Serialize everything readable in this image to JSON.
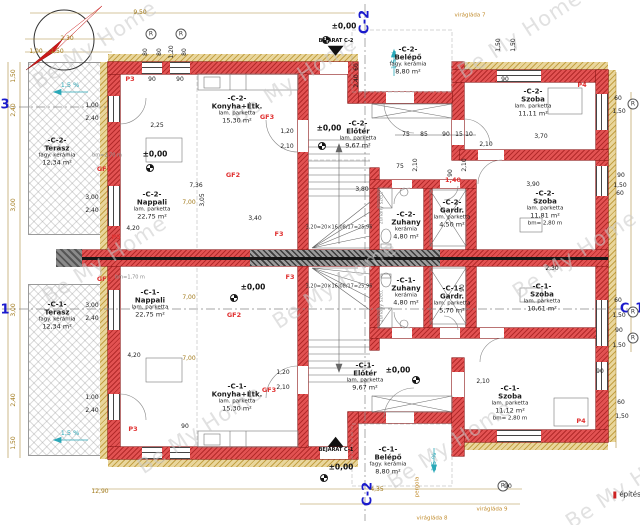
{
  "colors": {
    "wall": "#e25252",
    "insulation": "#e9d69c",
    "section_blue": "#1a1acc",
    "label_red": "#e03131",
    "slope_cyan": "#2aa8b8",
    "dim_orange": "#a07818",
    "watermark": "#c9c9c9"
  },
  "watermark_text": "Be My Home",
  "rooms": [
    {
      "u": "-C-2-",
      "n": "Terasz",
      "f": "fagy. kerámia",
      "a": "12,34 m²",
      "x": 57,
      "y": 152
    },
    {
      "u": "-C-1-",
      "n": "Terasz",
      "f": "fagy. kerámia",
      "a": "12,34 m²",
      "x": 57,
      "y": 316
    },
    {
      "u": "-C-2-",
      "n": "Nappali",
      "f": "lam. parketta",
      "a": "22,75 m²",
      "x": 152,
      "y": 206
    },
    {
      "u": "-C-1-",
      "n": "Nappali",
      "f": "lam. parketta",
      "a": "22,75 m²",
      "x": 150,
      "y": 304
    },
    {
      "u": "-C-2-",
      "n": "Konyha+Étk.",
      "f": "lam. parketta",
      "a": "15,30 m²",
      "x": 237,
      "y": 110
    },
    {
      "u": "-C-1-",
      "n": "Konyha+Étk.",
      "f": "lam. parketta",
      "a": "15,30 m²",
      "x": 237,
      "y": 398
    },
    {
      "u": "-C-2-",
      "n": "Előtér",
      "f": "lam. parketta",
      "a": "9,67 m²",
      "x": 358,
      "y": 135
    },
    {
      "u": "-C-1-",
      "n": "Előtér",
      "f": "lam. parketta",
      "a": "9,67 m²",
      "x": 365,
      "y": 377
    },
    {
      "u": "-C-2-",
      "n": "Zuhany",
      "f": "kerámia",
      "a": "4,80 m²",
      "x": 406,
      "y": 226
    },
    {
      "u": "-C-1-",
      "n": "Zuhany",
      "f": "kerámia",
      "a": "4,80 m²",
      "x": 406,
      "y": 292
    },
    {
      "u": "-C-2-",
      "n": "Gardr.",
      "f": "lam. parketta",
      "a": "4,50 m²",
      "x": 452,
      "y": 214
    },
    {
      "u": "-C-1-",
      "n": "Gardr.",
      "f": "lam. parketta",
      "a": "5,70 m²",
      "x": 452,
      "y": 300
    },
    {
      "u": "-C-2-",
      "n": "Szoba",
      "f": "lam. parketta",
      "a": "11,11 m²",
      "x": 533,
      "y": 103
    },
    {
      "u": "-C-2-",
      "n": "Szoba",
      "f": "lam. parketta",
      "a": "11,81 m²",
      "b": "bm= 2,80 m",
      "x": 545,
      "y": 208
    },
    {
      "u": "-C-1-",
      "n": "Szoba",
      "f": "lam. parketta",
      "a": "10,61 m²",
      "x": 542,
      "y": 298
    },
    {
      "u": "-C-1-",
      "n": "Szoba",
      "f": "lam. parketta",
      "a": "11,12 m²",
      "b": "bm= 2,80 m",
      "x": 510,
      "y": 403
    },
    {
      "u": "-C-2-",
      "n": "Belépő",
      "f": "fagy. kerámia",
      "a": "8,80 m²",
      "x": 408,
      "y": 61
    },
    {
      "u": "-C-1-",
      "n": "Belépő",
      "f": "fagy. kerámia",
      "a": "8,80 m²",
      "x": 388,
      "y": 461
    }
  ],
  "entrances": [
    {
      "label": "BEJÁRAT C-2",
      "x": 336,
      "y": 47,
      "dir": "down"
    },
    {
      "label": "BEJÁRAT C-1",
      "x": 336,
      "y": 445,
      "dir": "up"
    }
  ],
  "annotations": [
    {
      "t": "Be My Home",
      "x": 95,
      "y": 45,
      "c": "wm",
      "r": -33,
      "n": "watermark"
    },
    {
      "t": "Be My Home",
      "x": 295,
      "y": 80,
      "c": "wm",
      "r": -33,
      "n": "watermark"
    },
    {
      "t": "Be My Home",
      "x": 520,
      "y": 35,
      "c": "wm",
      "r": -33,
      "n": "watermark"
    },
    {
      "t": "Be My Home",
      "x": 105,
      "y": 260,
      "c": "wm",
      "r": -33,
      "n": "watermark"
    },
    {
      "t": "Be My Home",
      "x": 335,
      "y": 285,
      "c": "wm",
      "r": -33,
      "n": "watermark"
    },
    {
      "t": "Be My Home",
      "x": 575,
      "y": 255,
      "c": "wm",
      "r": -33,
      "n": "watermark"
    },
    {
      "t": "Be My Home",
      "x": 200,
      "y": 430,
      "c": "wm",
      "r": -33,
      "n": "watermark"
    },
    {
      "t": "Be My Home",
      "x": 450,
      "y": 445,
      "c": "wm",
      "r": -33,
      "n": "watermark"
    },
    {
      "t": "Be My Home",
      "x": 628,
      "y": 485,
      "c": "wm",
      "r": -33,
      "n": "watermark"
    },
    {
      "t": "C-2",
      "x": 365,
      "y": 22,
      "c": "sec",
      "r": -90,
      "n": "section-label"
    },
    {
      "t": "C-2",
      "x": 368,
      "y": 494,
      "c": "sec",
      "r": -90,
      "n": "section-label"
    },
    {
      "t": "3",
      "x": 5,
      "y": 105,
      "c": "sec",
      "n": "section-label"
    },
    {
      "t": "1",
      "x": 5,
      "y": 310,
      "c": "sec",
      "n": "section-label"
    },
    {
      "t": "C-1",
      "x": 632,
      "y": 309,
      "c": "sec",
      "n": "section-label"
    },
    {
      "t": "±0,00",
      "x": 344,
      "y": 26,
      "c": "kb",
      "n": "level-text"
    },
    {
      "t": "±0,00",
      "x": 155,
      "y": 154,
      "c": "kb",
      "n": "level-text"
    },
    {
      "t": "±0,00",
      "x": 329,
      "y": 128,
      "c": "kb",
      "n": "level-text"
    },
    {
      "t": "±0,00",
      "x": 253,
      "y": 287,
      "c": "kb",
      "n": "level-text"
    },
    {
      "t": "±0,00",
      "x": 398,
      "y": 370,
      "c": "kb",
      "n": "level-text"
    },
    {
      "t": "±0,00",
      "x": 341,
      "y": 467,
      "c": "kb",
      "n": "level-text"
    },
    {
      "t": "",
      "x": 326,
      "y": 40,
      "c": "lvl",
      "n": "level-marker-icon"
    },
    {
      "t": "",
      "x": 150,
      "y": 168,
      "c": "lvl",
      "n": "level-marker-icon"
    },
    {
      "t": "",
      "x": 322,
      "y": 146,
      "c": "lvl",
      "n": "level-marker-icon"
    },
    {
      "t": "",
      "x": 234,
      "y": 298,
      "c": "lvl",
      "n": "level-marker-icon"
    },
    {
      "t": "",
      "x": 416,
      "y": 380,
      "c": "lvl",
      "n": "level-marker-icon"
    },
    {
      "t": "",
      "x": 324,
      "y": 478,
      "c": "lvl",
      "n": "level-marker-icon"
    },
    {
      "t": "R",
      "x": 151,
      "y": 34,
      "c": "circ",
      "n": "circled-r-marker"
    },
    {
      "t": "R",
      "x": 181,
      "y": 34,
      "c": "circ",
      "n": "circled-r-marker"
    },
    {
      "t": "R",
      "x": 503,
      "y": 486,
      "c": "circ",
      "n": "circled-r-marker"
    },
    {
      "t": "R",
      "x": 633,
      "y": 104,
      "c": "circ",
      "n": "circled-r-marker"
    },
    {
      "t": "R",
      "x": 633,
      "y": 312,
      "c": "circ",
      "n": "circled-r-marker"
    },
    {
      "t": "R",
      "x": 633,
      "y": 338,
      "c": "circ",
      "n": "circled-r-marker"
    },
    {
      "t": "P3",
      "x": 130,
      "y": 79,
      "c": "red",
      "n": "opening-label"
    },
    {
      "t": "P3",
      "x": 133,
      "y": 429,
      "c": "red",
      "n": "opening-label"
    },
    {
      "t": "P4",
      "x": 582,
      "y": 85,
      "c": "red",
      "n": "opening-label"
    },
    {
      "t": "P4",
      "x": 581,
      "y": 421,
      "c": "red",
      "n": "opening-label"
    },
    {
      "t": "P5",
      "x": 116,
      "y": 237,
      "c": "red",
      "n": "opening-label"
    },
    {
      "t": "F3",
      "x": 279,
      "y": 234,
      "c": "red",
      "n": "opening-label"
    },
    {
      "t": "F3",
      "x": 290,
      "y": 277,
      "c": "red",
      "n": "opening-label"
    },
    {
      "t": "GF1",
      "x": 104,
      "y": 169,
      "c": "red",
      "n": "opening-label"
    },
    {
      "t": "GF1",
      "x": 104,
      "y": 279,
      "c": "red",
      "n": "opening-label"
    },
    {
      "t": "GF2",
      "x": 233,
      "y": 175,
      "c": "red",
      "n": "opening-label"
    },
    {
      "t": "GF2",
      "x": 234,
      "y": 315,
      "c": "red",
      "n": "opening-label"
    },
    {
      "t": "GF3",
      "x": 267,
      "y": 117,
      "c": "red",
      "n": "opening-label"
    },
    {
      "t": "GF3",
      "x": 269,
      "y": 390,
      "c": "red",
      "n": "opening-label"
    },
    {
      "t": "1,40",
      "x": 453,
      "y": 180,
      "c": "red",
      "n": "opening-label"
    },
    {
      "t": "1,5 %",
      "x": 70,
      "y": 85,
      "c": "c",
      "n": "slope-label"
    },
    {
      "t": "1,5 %",
      "x": 70,
      "y": 433,
      "c": "c",
      "n": "slope-label"
    },
    {
      "t": "1,5 %",
      "x": 394,
      "y": 60,
      "c": "c",
      "r": -90,
      "n": "slope-label"
    },
    {
      "t": "1,5 %",
      "x": 434,
      "y": 462,
      "c": "c",
      "r": -90,
      "n": "slope-label"
    },
    {
      "t": "virágláda 7",
      "x": 470,
      "y": 16,
      "c": "note",
      "n": "site-note"
    },
    {
      "t": "virágláda 8",
      "x": 432,
      "y": 519,
      "c": "note",
      "n": "site-note"
    },
    {
      "t": "virágláda 9",
      "x": 492,
      "y": 510,
      "c": "note",
      "n": "site-note"
    },
    {
      "t": "pergola",
      "x": 418,
      "y": 487,
      "c": "note",
      "r": -90,
      "n": "site-note"
    },
    {
      "t": "bm=2,70 m",
      "x": 107,
      "y": 156,
      "c": "gray",
      "n": "height-note"
    },
    {
      "t": "bm=1,70 m",
      "x": 130,
      "y": 278,
      "c": "gray",
      "n": "height-note"
    },
    {
      "t": "zuhany szett",
      "x": 382,
      "y": 208,
      "c": "gray",
      "r": -90,
      "n": "fixture-note"
    },
    {
      "t": "zuhany szett",
      "x": 382,
      "y": 306,
      "c": "gray",
      "r": -90,
      "n": "fixture-note"
    },
    {
      "t": "3,20=20×16,08/17=25,96",
      "x": 339,
      "y": 228,
      "c": "st",
      "n": "stair-formula"
    },
    {
      "t": "3,20=20×16,08/17=25,96",
      "x": 339,
      "y": 287,
      "c": "st",
      "n": "stair-formula"
    },
    {
      "t": "építési",
      "x": 628,
      "y": 495,
      "c": "foot",
      "n": "sheet-note"
    },
    {
      "t": "2,30",
      "x": 67,
      "y": 39,
      "c": "o"
    },
    {
      "t": "1,00",
      "x": 36,
      "y": 52,
      "c": "o"
    },
    {
      "t": "1,50",
      "x": 57,
      "y": 52,
      "c": "o"
    },
    {
      "t": "9,50",
      "x": 140,
      "y": 13,
      "c": "o"
    },
    {
      "t": "12,90",
      "x": 100,
      "y": 492,
      "c": "o"
    },
    {
      "t": "4,35",
      "x": 377,
      "y": 490,
      "c": "o"
    },
    {
      "t": "7,00",
      "x": 189,
      "y": 203,
      "c": "o"
    },
    {
      "t": "7,00",
      "x": 189,
      "y": 298,
      "c": "o"
    },
    {
      "t": "7,00",
      "x": 189,
      "y": 359,
      "c": "o"
    },
    {
      "t": "1,50",
      "x": 14,
      "y": 76,
      "c": "o",
      "r": -90
    },
    {
      "t": "2,40",
      "x": 14,
      "y": 110,
      "c": "o",
      "r": -90
    },
    {
      "t": "3,00",
      "x": 14,
      "y": 205,
      "c": "o",
      "r": -90
    },
    {
      "t": "3,00",
      "x": 14,
      "y": 310,
      "c": "o",
      "r": -90
    },
    {
      "t": "2,40",
      "x": 14,
      "y": 400,
      "c": "o",
      "r": -90
    },
    {
      "t": "1,50",
      "x": 14,
      "y": 443,
      "c": "o",
      "r": -90
    },
    {
      "t": "80",
      "x": 146,
      "y": 52,
      "c": "k",
      "r": -90
    },
    {
      "t": "80",
      "x": 160,
      "y": 52,
      "c": "k",
      "r": -90
    },
    {
      "t": "1,20",
      "x": 172,
      "y": 52,
      "c": "k",
      "r": -90
    },
    {
      "t": "80",
      "x": 185,
      "y": 52,
      "c": "k",
      "r": -90
    },
    {
      "t": "90",
      "x": 152,
      "y": 80,
      "c": "k"
    },
    {
      "t": "90",
      "x": 180,
      "y": 80,
      "c": "k"
    },
    {
      "t": "1,50",
      "x": 499,
      "y": 45,
      "c": "k",
      "r": -90
    },
    {
      "t": "1,50",
      "x": 514,
      "y": 45,
      "c": "k",
      "r": -90
    },
    {
      "t": "90",
      "x": 505,
      "y": 80,
      "c": "k"
    },
    {
      "t": "60",
      "x": 357,
      "y": 67,
      "c": "k",
      "r": -90
    },
    {
      "t": "2,40",
      "x": 357,
      "y": 81,
      "c": "k",
      "r": -90
    },
    {
      "t": "60",
      "x": 618,
      "y": 99,
      "c": "k"
    },
    {
      "t": "1,50",
      "x": 619,
      "y": 112,
      "c": "k"
    },
    {
      "t": "90",
      "x": 621,
      "y": 176,
      "c": "k"
    },
    {
      "t": "1,50",
      "x": 620,
      "y": 186,
      "c": "k"
    },
    {
      "t": "60",
      "x": 620,
      "y": 194,
      "c": "k"
    },
    {
      "t": "60",
      "x": 618,
      "y": 301,
      "c": "k"
    },
    {
      "t": "1,50",
      "x": 619,
      "y": 316,
      "c": "k"
    },
    {
      "t": "90",
      "x": 619,
      "y": 331,
      "c": "k"
    },
    {
      "t": "1,50",
      "x": 619,
      "y": 346,
      "c": "k"
    },
    {
      "t": "90",
      "x": 600,
      "y": 372,
      "c": "k"
    },
    {
      "t": "60",
      "x": 621,
      "y": 403,
      "c": "k"
    },
    {
      "t": "1,50",
      "x": 622,
      "y": 417,
      "c": "k"
    },
    {
      "t": "90",
      "x": 508,
      "y": 487,
      "c": "k"
    },
    {
      "t": "1,00",
      "x": 92,
      "y": 106,
      "c": "k"
    },
    {
      "t": "2,40",
      "x": 92,
      "y": 119,
      "c": "k"
    },
    {
      "t": "3,00",
      "x": 92,
      "y": 198,
      "c": "k"
    },
    {
      "t": "2,40",
      "x": 92,
      "y": 211,
      "c": "k"
    },
    {
      "t": "3,00",
      "x": 92,
      "y": 306,
      "c": "k"
    },
    {
      "t": "2,40",
      "x": 92,
      "y": 319,
      "c": "k"
    },
    {
      "t": "1,00",
      "x": 92,
      "y": 398,
      "c": "k"
    },
    {
      "t": "2,40",
      "x": 92,
      "y": 411,
      "c": "k"
    },
    {
      "t": "1,20",
      "x": 287,
      "y": 132,
      "c": "k"
    },
    {
      "t": "2,10",
      "x": 287,
      "y": 147,
      "c": "k"
    },
    {
      "t": "1,20",
      "x": 283,
      "y": 373,
      "c": "k"
    },
    {
      "t": "2,10",
      "x": 283,
      "y": 388,
      "c": "k"
    },
    {
      "t": "2,25",
      "x": 157,
      "y": 126,
      "c": "k"
    },
    {
      "t": "7,36",
      "x": 196,
      "y": 186,
      "c": "k"
    },
    {
      "t": "3,05",
      "x": 203,
      "y": 200,
      "c": "k",
      "r": -90
    },
    {
      "t": "3,40",
      "x": 255,
      "y": 219,
      "c": "k"
    },
    {
      "t": "4,20",
      "x": 133,
      "y": 229,
      "c": "k"
    },
    {
      "t": "4,20",
      "x": 134,
      "y": 356,
      "c": "k"
    },
    {
      "t": "3,80",
      "x": 362,
      "y": 190,
      "c": "k"
    },
    {
      "t": "3,70",
      "x": 541,
      "y": 137,
      "c": "k"
    },
    {
      "t": "3,90",
      "x": 533,
      "y": 185,
      "c": "k"
    },
    {
      "t": "2,30",
      "x": 552,
      "y": 269,
      "c": "k"
    },
    {
      "t": "2,10",
      "x": 486,
      "y": 145,
      "c": "k"
    },
    {
      "t": "2,10",
      "x": 483,
      "y": 382,
      "c": "k"
    },
    {
      "t": "90",
      "x": 463,
      "y": 288,
      "c": "k",
      "r": -90
    },
    {
      "t": "75",
      "x": 406,
      "y": 135,
      "c": "k"
    },
    {
      "t": "85",
      "x": 424,
      "y": 135,
      "c": "k"
    },
    {
      "t": "90",
      "x": 446,
      "y": 135,
      "c": "k"
    },
    {
      "t": "15",
      "x": 459,
      "y": 135,
      "c": "k"
    },
    {
      "t": "10",
      "x": 469,
      "y": 135,
      "c": "k"
    },
    {
      "t": "2,10",
      "x": 416,
      "y": 165,
      "c": "k",
      "r": -90
    },
    {
      "t": "75",
      "x": 400,
      "y": 167,
      "c": "k"
    },
    {
      "t": "90",
      "x": 451,
      "y": 173,
      "c": "k",
      "r": -90
    },
    {
      "t": "2,10",
      "x": 465,
      "y": 165,
      "c": "k",
      "r": -90
    },
    {
      "t": "90",
      "x": 185,
      "y": 427,
      "c": "k"
    }
  ]
}
